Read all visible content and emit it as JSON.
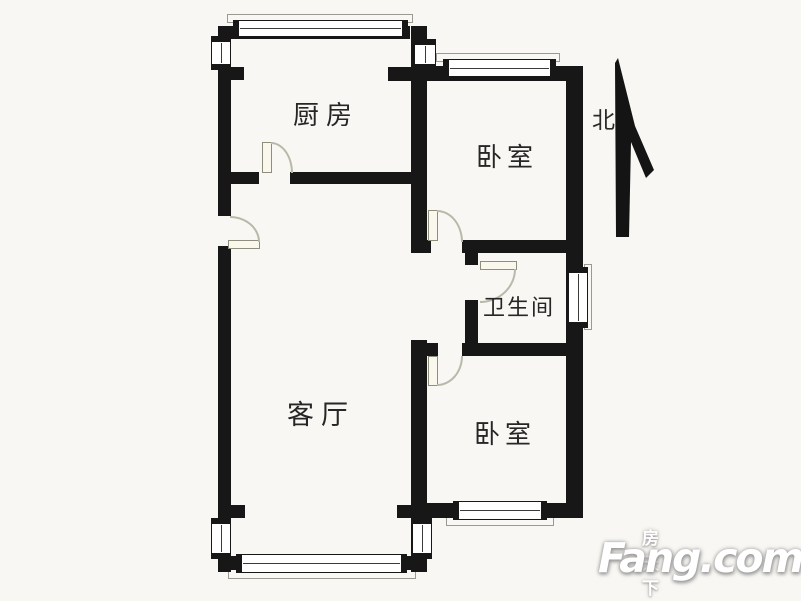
{
  "floorplan": {
    "rooms": [
      {
        "id": "kitchen",
        "label": "厨房"
      },
      {
        "id": "bedroom-north",
        "label": "卧室"
      },
      {
        "id": "bathroom",
        "label": "卫生间"
      },
      {
        "id": "living-room",
        "label": "客厅"
      },
      {
        "id": "bedroom-south",
        "label": "卧室"
      }
    ],
    "compass": {
      "label": "北",
      "direction": "up"
    },
    "colors": {
      "wall": "#171717",
      "door_arc": "#b9b9aa",
      "text": "#262626",
      "background": "#f8f7f3"
    }
  },
  "watermark": {
    "brand_cn": "房天下",
    "brand_en": "Fang.com",
    "color": "#ffffff"
  }
}
